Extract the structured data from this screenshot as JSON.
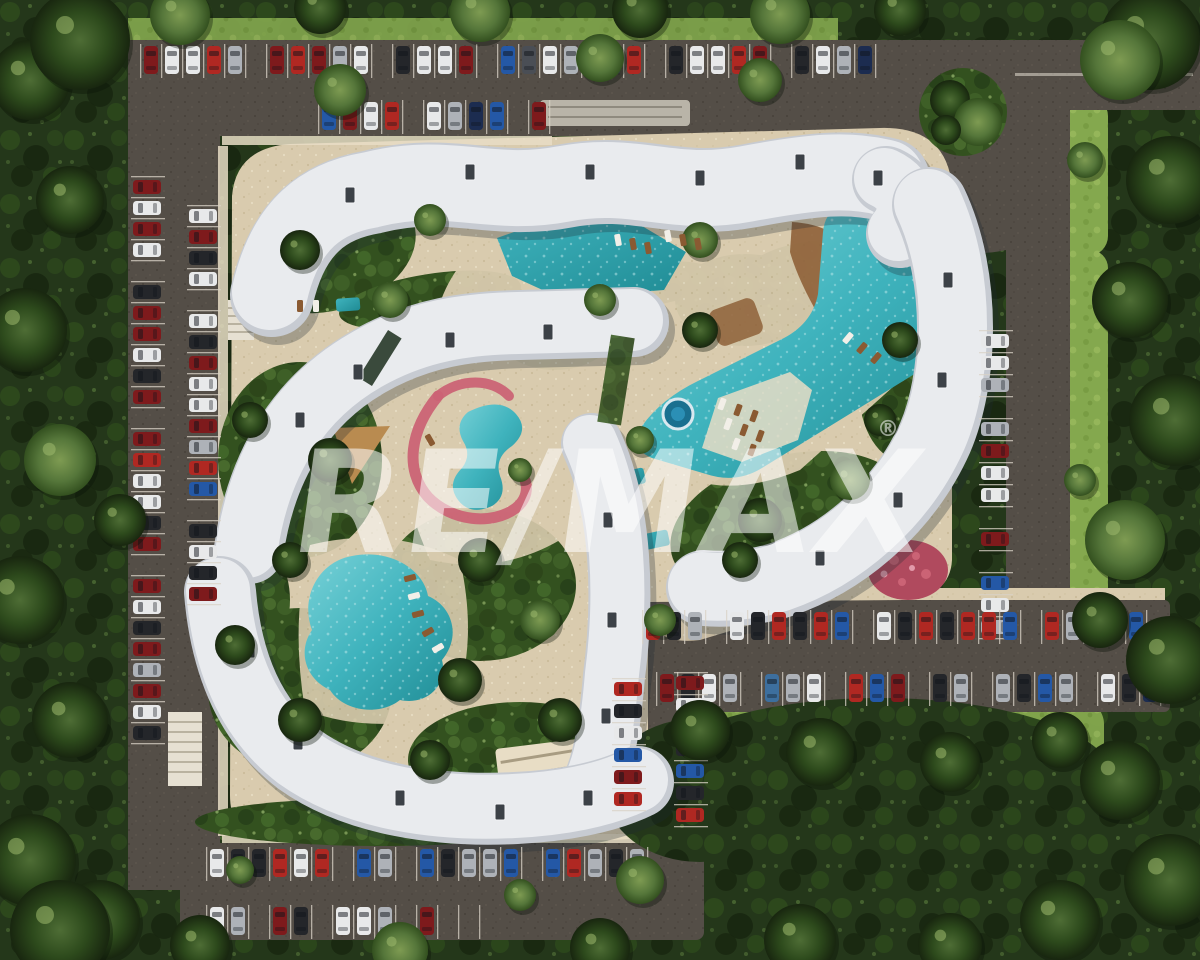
{
  "title": "Aerial 3D master-plan render of a resort condominium complex",
  "watermark": {
    "text": "RE/MAX",
    "registered": "®"
  },
  "palette": {
    "forest_base": "#24371a",
    "forest_dark": "#18260f",
    "forest_mid": "#2d4a1c",
    "forest_light": "#4e6d35",
    "lawn": "#84a84e",
    "lawn_light": "#9dbd60",
    "road": "#544e47",
    "road_dark": "#453f38",
    "stall_line": "#d8d2c6",
    "sand": "#d9cbae",
    "sand_light": "#e8ddc5",
    "walk_gray": "#b9b4a8",
    "building": "#e9ebee",
    "building_edge": "#c7cbd2",
    "roof_detail": "#3c4147",
    "pool_deep": "#1f8b94",
    "pool": "#3fb3bd",
    "pool_light": "#79d2d8",
    "water_dot": "#bfe9ec",
    "jacuzzi": "#1a6f8f",
    "pink": "#cb6375",
    "pink_dark": "#b04a5e",
    "wood": "#8e6038",
    "watermark_fill": "rgba(255,255,255,0.55)"
  },
  "car_colors": {
    "W": "#e8e9ea",
    "S": "#aeb2b8",
    "K": "#24262a",
    "D": "#4a4e55",
    "R": "#7e1a1c",
    "r": "#b02822",
    "B": "#2458a6",
    "N": "#1c2c50",
    "T": "#3d6f9e",
    "G": "#6d7278"
  },
  "parking": {
    "rows": [
      {
        "name": "north-outer-row",
        "x": 140,
        "y": 46,
        "dir": "h",
        "stall": 21,
        "cars": [
          "R",
          "W",
          "W",
          "r",
          "S",
          "",
          "R",
          "r",
          "R",
          "S",
          "W",
          "",
          "K",
          "W",
          "W",
          "R",
          "",
          "B",
          "D",
          "W",
          "S",
          "R",
          "B",
          "r",
          "",
          "K",
          "W",
          "W",
          "r",
          "R",
          "",
          "K",
          "W",
          "S",
          "N"
        ]
      },
      {
        "name": "north-inner-row",
        "x": 318,
        "y": 102,
        "dir": "h",
        "stall": 21,
        "cars": [
          "B",
          "R",
          "W",
          "r",
          "",
          "W",
          "S",
          "N",
          "B",
          "",
          "R"
        ]
      },
      {
        "name": "west-outer-row",
        "x": 133,
        "y": 176,
        "dir": "v",
        "stall": 21,
        "cars": [
          "R",
          "W",
          "R",
          "W",
          "",
          "K",
          "R",
          "R",
          "W",
          "K",
          "R",
          "",
          "R",
          "r",
          "W",
          "W",
          "K",
          "R",
          "",
          "R",
          "W",
          "K",
          "R",
          "S",
          "R",
          "W",
          "K"
        ]
      },
      {
        "name": "west-inner-row",
        "x": 189,
        "y": 205,
        "dir": "v",
        "stall": 21,
        "cars": [
          "W",
          "R",
          "K",
          "W",
          "",
          "W",
          "K",
          "R",
          "W",
          "W",
          "R",
          "S",
          "r",
          "B",
          "",
          "K",
          "W",
          "K",
          "R"
        ]
      },
      {
        "name": "east-row",
        "x": 981,
        "y": 330,
        "dir": "v",
        "stall": 22,
        "cars": [
          "W",
          "W",
          "S",
          "",
          "S",
          "R",
          "W",
          "W",
          "",
          "R",
          "",
          "B",
          "W",
          "S"
        ]
      },
      {
        "name": "southeast-outer-row",
        "x": 642,
        "y": 612,
        "dir": "h",
        "stall": 21,
        "cars": [
          "r",
          "K",
          "S",
          "",
          "W",
          "K",
          "r",
          "K",
          "r",
          "B",
          "",
          "W",
          "K",
          "r",
          "K",
          "r",
          "r",
          "B",
          "",
          "r",
          "S",
          "r",
          "K",
          "B"
        ]
      },
      {
        "name": "southeast-inner-row",
        "x": 656,
        "y": 674,
        "dir": "h",
        "stall": 21,
        "cars": [
          "R",
          "K",
          "W",
          "S",
          "",
          "T",
          "S",
          "W",
          "",
          "r",
          "B",
          "R",
          "",
          "K",
          "S",
          "",
          "S",
          "K",
          "B",
          "S",
          "",
          "W",
          "K",
          "N"
        ]
      },
      {
        "name": "south-outer-row",
        "x": 206,
        "y": 849,
        "dir": "h",
        "stall": 21,
        "cars": [
          "W",
          "K",
          "K",
          "r",
          "W",
          "r",
          "",
          "B",
          "S",
          "",
          "B",
          "K",
          "S",
          "S",
          "B",
          "",
          "B",
          "r",
          "S",
          "K",
          "S"
        ]
      },
      {
        "name": "south-inner-row",
        "x": 206,
        "y": 907,
        "dir": "h",
        "stall": 21,
        "cars": [
          "W",
          "S",
          "",
          "R",
          "K",
          "",
          "W",
          "W",
          "S",
          "",
          "R",
          "",
          ""
        ]
      },
      {
        "name": "court-west-row",
        "x": 614,
        "y": 678,
        "dir": "v",
        "stall": 22,
        "cars": [
          "r",
          "K",
          "W",
          "B",
          "R",
          "r"
        ]
      },
      {
        "name": "court-east-row",
        "x": 676,
        "y": 672,
        "dir": "v",
        "stall": 22,
        "cars": [
          "R",
          "W",
          "r",
          "K",
          "B",
          "K",
          "r"
        ]
      }
    ]
  },
  "features": {
    "buildings": [
      "north curved block",
      "west curved block",
      "east curved block",
      "central block",
      "south curved block"
    ],
    "pools": [
      "north lap pool",
      "lagoon pool with swim-up deck and jacuzzi",
      "kids pool with play stream",
      "garden pool",
      "plunge pools"
    ],
    "amenities": [
      "sun loungers",
      "timber deck",
      "garden courtyards",
      "outdoor stairs",
      "roundabout tree island",
      "pink flower garden"
    ]
  }
}
